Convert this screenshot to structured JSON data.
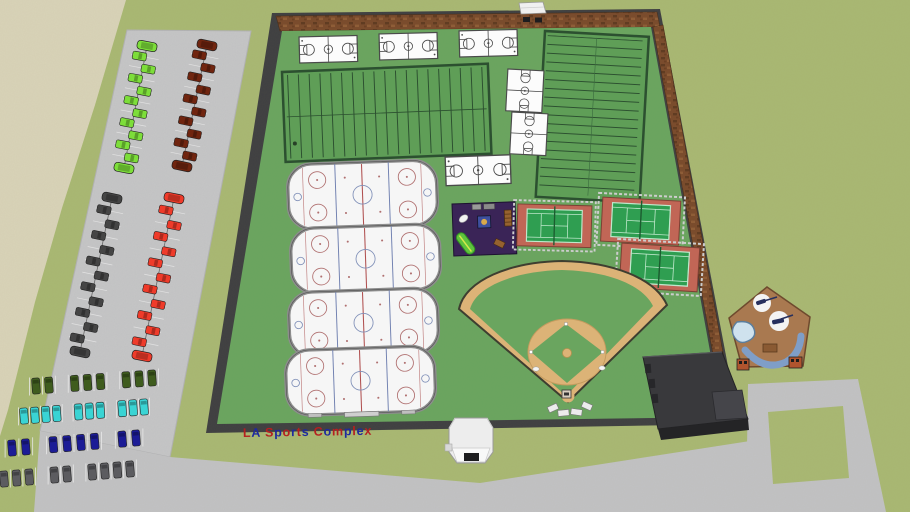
{
  "sign": {
    "text": "LA Sports Complex",
    "letter_colors": [
      "#b42020",
      "#1e2a9e"
    ]
  },
  "facilities": {
    "basketball_courts": 6,
    "hockey_rinks": 4,
    "tennis_courts": 3,
    "football_fields": 2,
    "baseball_diamonds": 1,
    "playgrounds": 1,
    "pool_clubhouses": 1,
    "gatehouses": 1,
    "service_buildings": 1
  },
  "parking": {
    "columns": [
      {
        "label": "lime-cars",
        "color": "#7dde3a",
        "count": 12
      },
      {
        "label": "maroon-cars",
        "color": "#70250f",
        "count": 12
      },
      {
        "label": "dark-gray-cars",
        "color": "#454545",
        "count": 13
      },
      {
        "label": "red-cars",
        "color": "#ef3b2a",
        "count": 13
      }
    ],
    "rows": [
      {
        "label": "dark-green-cars",
        "color": "#3f5c1e",
        "count": 8
      },
      {
        "label": "cyan-cars",
        "color": "#3ad4d4",
        "count": 10
      },
      {
        "label": "navy-cars",
        "color": "#1c1c96",
        "count": 8
      },
      {
        "label": "gray-cars",
        "color": "#5c5c60",
        "count": 9
      }
    ]
  },
  "colors": {
    "grass": "#a9b873",
    "dirt_lot": "#d9d3b8",
    "pavement": "#c5c5c7",
    "complex_lawn": "#6aa55f",
    "wall": "#3f3f41",
    "brick": "#7a4a2b",
    "field_green": "#5f9e57",
    "ice": "#f6f6f6",
    "tennis_surround": "#c16656",
    "tennis_court": "#35a055",
    "infield_dirt": "#dcb377",
    "playground_base": "#3a2457",
    "service_building": "#39393c",
    "clubhouse": "#a97950",
    "pool_water": "#cfe2ee",
    "slide_blue": "#7f9ec8",
    "gatehouse": "#efefef"
  }
}
